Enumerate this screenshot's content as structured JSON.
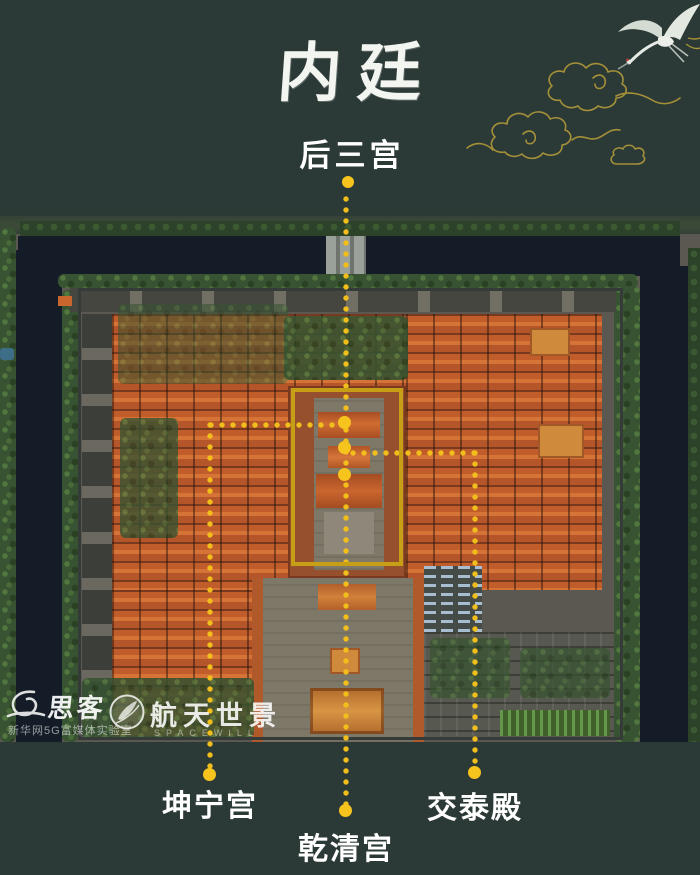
{
  "colors": {
    "background": "#2b3a36",
    "highlight_rectangle_gold": "#c79f16",
    "dot_yellow": "#f7c41e",
    "label_white": "#ffffff"
  },
  "header": {
    "title": "内廷"
  },
  "callouts": {
    "top": {
      "label": "后三宫"
    },
    "bottom": [
      {
        "id": "kunning",
        "label": "坤宁宫"
      },
      {
        "id": "qianqing",
        "label": "乾清宫"
      },
      {
        "id": "jiaotai",
        "label": "交泰殿"
      }
    ]
  },
  "watermarks": {
    "sike": {
      "name": "思客",
      "subtitle": "新华网5G富媒体实验室"
    },
    "spacewill": {
      "name": "航天世景",
      "subtitle": "SPACEWILL"
    }
  },
  "icons": {
    "crane": "crane-icon",
    "clouds": "golden-clouds-icon",
    "sike_logo": "sike-swirl-logo-icon",
    "spacewill_logo": "spacewill-compass-logo-icon"
  }
}
